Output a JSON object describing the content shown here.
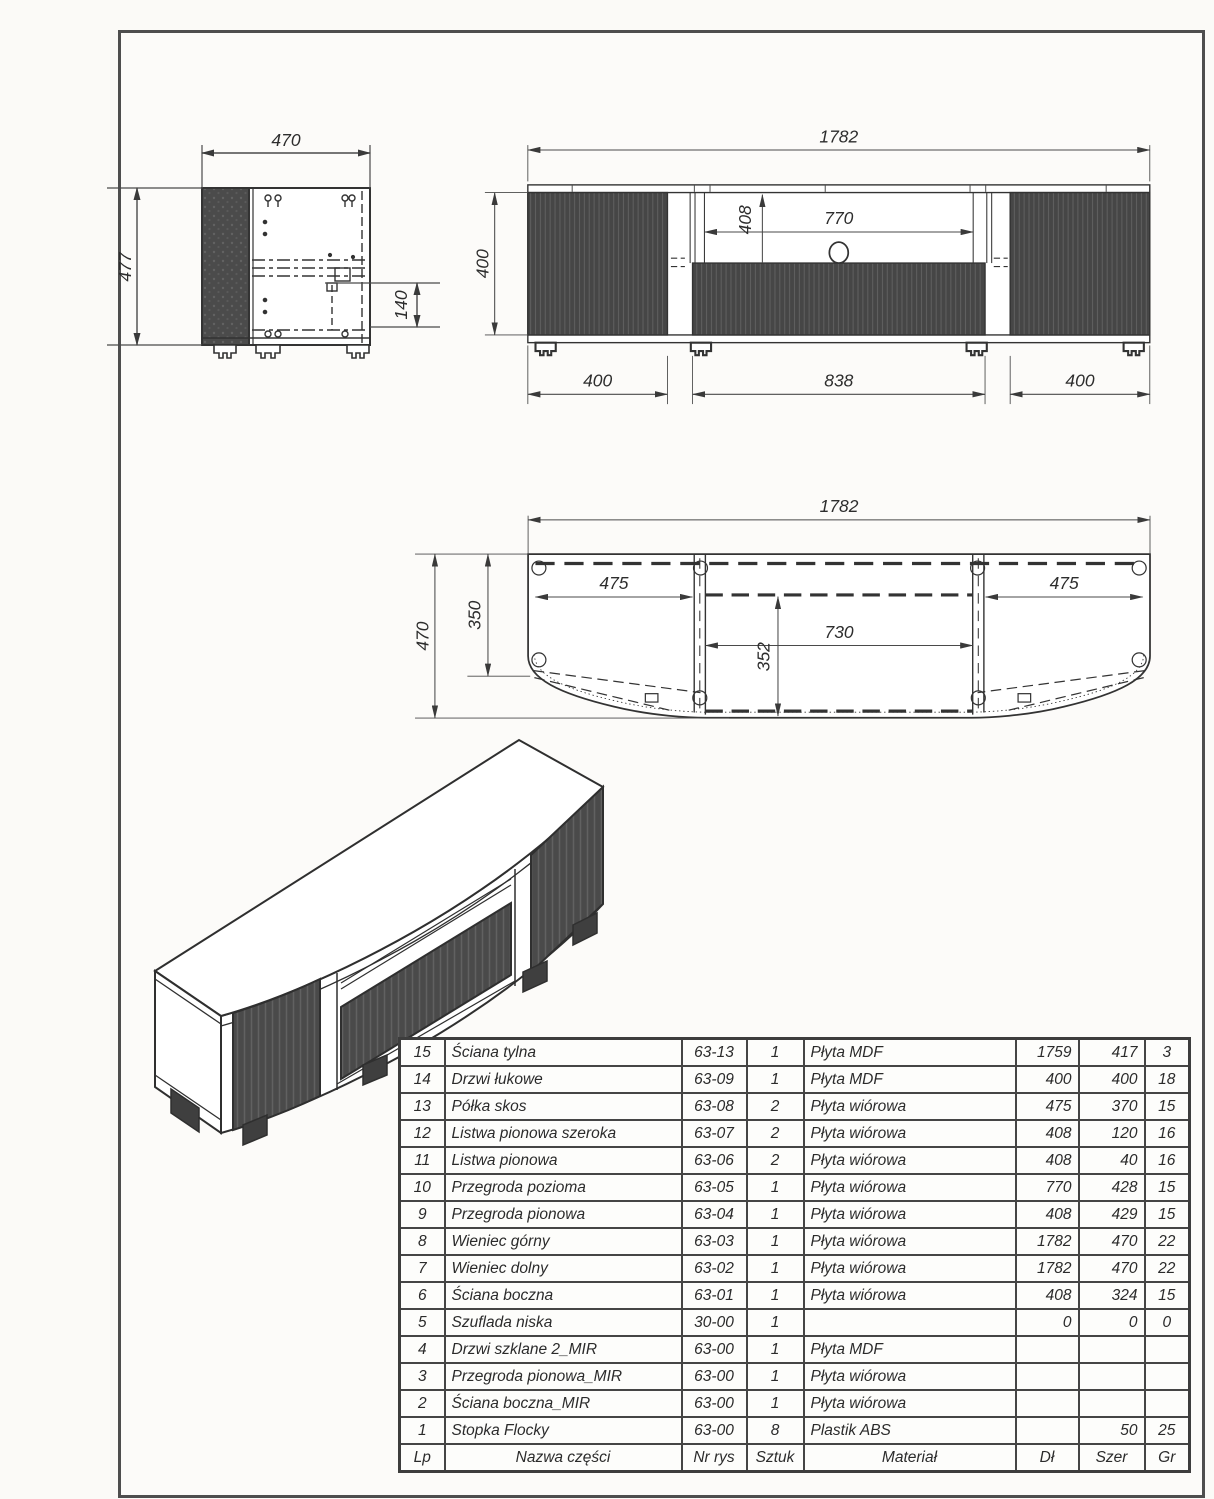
{
  "dims": {
    "side": {
      "width": "470",
      "height": "477",
      "drawer": "140"
    },
    "front": {
      "total": "1782",
      "door_height": "400",
      "opening_height": "408",
      "niche_width": "770",
      "bottom_left": "400",
      "bottom_center": "838",
      "bottom_right": "400"
    },
    "top": {
      "total": "1782",
      "depth": "470",
      "back_depth": "350",
      "shelf_left": "475",
      "shelf_right": "475",
      "niche_width": "730",
      "niche_depth": "352"
    }
  },
  "colors": {
    "line": "#3a3a3a",
    "panel_dark": "#474747",
    "paper": "#fcfbf9"
  },
  "parts_table": {
    "columns": [
      "Lp",
      "Nazwa części",
      "Nr rys",
      "Sztuk",
      "Materiał",
      "Dł",
      "Szer",
      "Gr"
    ],
    "rows": [
      [
        "15",
        "Ściana tylna",
        "63-13",
        "1",
        "Płyta MDF",
        "1759",
        "417",
        "3"
      ],
      [
        "14",
        "Drzwi łukowe",
        "63-09",
        "1",
        "Płyta MDF",
        "400",
        "400",
        "18"
      ],
      [
        "13",
        "Półka skos",
        "63-08",
        "2",
        "Płyta wiórowa",
        "475",
        "370",
        "15"
      ],
      [
        "12",
        "Listwa pionowa szeroka",
        "63-07",
        "2",
        "Płyta wiórowa",
        "408",
        "120",
        "16"
      ],
      [
        "11",
        "Listwa pionowa",
        "63-06",
        "2",
        "Płyta wiórowa",
        "408",
        "40",
        "16"
      ],
      [
        "10",
        "Przegroda pozioma",
        "63-05",
        "1",
        "Płyta wiórowa",
        "770",
        "428",
        "15"
      ],
      [
        "9",
        "Przegroda pionowa",
        "63-04",
        "1",
        "Płyta wiórowa",
        "408",
        "429",
        "15"
      ],
      [
        "8",
        "Wieniec górny",
        "63-03",
        "1",
        "Płyta wiórowa",
        "1782",
        "470",
        "22"
      ],
      [
        "7",
        "Wieniec dolny",
        "63-02",
        "1",
        "Płyta wiórowa",
        "1782",
        "470",
        "22"
      ],
      [
        "6",
        "Ściana boczna",
        "63-01",
        "1",
        "Płyta wiórowa",
        "408",
        "324",
        "15"
      ],
      [
        "5",
        "Szuflada niska",
        "30-00",
        "1",
        "",
        "0",
        "0",
        "0"
      ],
      [
        "4",
        "Drzwi szklane 2_MIR",
        "63-00",
        "1",
        "Płyta MDF",
        "",
        "",
        ""
      ],
      [
        "3",
        "Przegroda pionowa_MIR",
        "63-00",
        "1",
        "Płyta wiórowa",
        "",
        "",
        ""
      ],
      [
        "2",
        "Ściana boczna_MIR",
        "63-00",
        "1",
        "Płyta wiórowa",
        "",
        "",
        ""
      ],
      [
        "1",
        "Stopka Flocky",
        "63-00",
        "8",
        "Plastik ABS",
        "",
        "50",
        "25"
      ]
    ]
  }
}
